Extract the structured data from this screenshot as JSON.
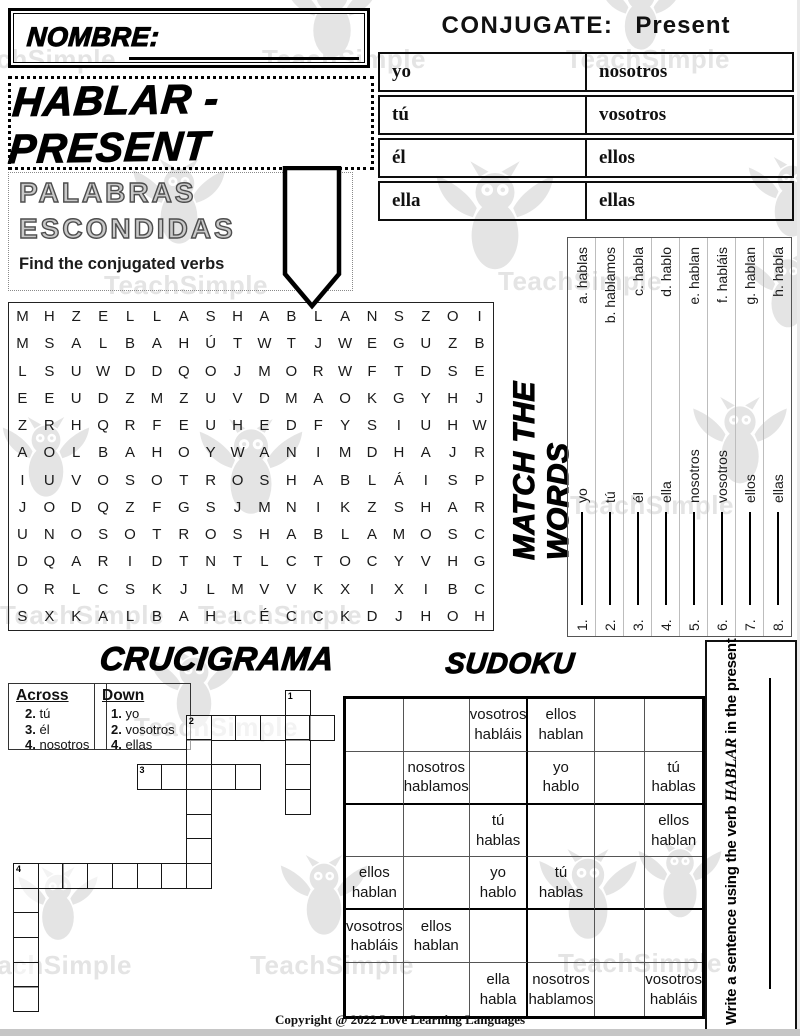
{
  "watermark": {
    "text": "TeachSimple",
    "color": "#e4e4e4",
    "items": [
      {
        "t": "owl",
        "x": 280,
        "y": -30,
        "s": 104
      },
      {
        "t": "owl",
        "x": 596,
        "y": -26,
        "s": 90
      },
      {
        "t": "text",
        "x": -48,
        "y": 44
      },
      {
        "t": "text",
        "x": 262,
        "y": 44
      },
      {
        "t": "text",
        "x": 566,
        "y": 44
      },
      {
        "t": "owl",
        "x": 128,
        "y": 158,
        "s": 102
      },
      {
        "t": "owl",
        "x": 430,
        "y": 160,
        "s": 130
      },
      {
        "t": "owl",
        "x": 744,
        "y": 156,
        "s": 96
      },
      {
        "t": "text",
        "x": 104,
        "y": 270
      },
      {
        "t": "text",
        "x": 498,
        "y": 266
      },
      {
        "t": "owl",
        "x": 742,
        "y": 250,
        "s": 92
      },
      {
        "t": "owl",
        "x": -2,
        "y": 416,
        "s": 96
      },
      {
        "t": "owl",
        "x": 194,
        "y": 418,
        "s": 114
      },
      {
        "t": "owl",
        "x": 688,
        "y": 396,
        "s": 104
      },
      {
        "t": "text",
        "x": 570,
        "y": 490
      },
      {
        "t": "text",
        "x": 0,
        "y": 600
      },
      {
        "t": "text",
        "x": 198,
        "y": 600
      },
      {
        "t": "owl",
        "x": 146,
        "y": 648,
        "s": 96
      },
      {
        "t": "text",
        "x": 134,
        "y": 712
      },
      {
        "t": "owl",
        "x": 14,
        "y": 866,
        "s": 88
      },
      {
        "t": "owl",
        "x": 276,
        "y": 854,
        "s": 96
      },
      {
        "t": "owl",
        "x": 534,
        "y": 848,
        "s": 108
      },
      {
        "t": "owl",
        "x": 634,
        "y": 840,
        "s": 92
      },
      {
        "t": "text",
        "x": -32,
        "y": 950
      },
      {
        "t": "text",
        "x": 250,
        "y": 950
      },
      {
        "t": "text",
        "x": 558,
        "y": 948
      }
    ]
  },
  "nombre": {
    "label": "NOMBRE:"
  },
  "conjugate": {
    "title": "CONJUGATE:",
    "tense": "Present",
    "rows": [
      [
        "yo",
        "nosotros"
      ],
      [
        "tú",
        "vosotros"
      ],
      [
        "él",
        "ellos"
      ],
      [
        "ella",
        "ellas"
      ]
    ]
  },
  "main_title": "HABLAR - PRESENT",
  "palabras": {
    "line1": "PALABRAS",
    "line2": "ESCONDIDAS",
    "subtitle": "Find the conjugated verbs"
  },
  "wordsearch": {
    "rows": [
      "MHZELLASHABLANSZOI",
      "MSALBAHÚTWTJWEGUZB",
      "LSUWDDQOJMORWFTDSE",
      "EEUDZMZUVDMAOKGYHJ",
      "ZRHQRFEUHEDFYSIUHW",
      "AOLBAHOYWANIMDHAJR",
      "IUVOSOTROSHABLÁISP",
      "JODQZFGSJMNIKZSHAR",
      "UNOSOTROSHABLAMOSC",
      "DQARIDTNTLCTOCYVHG",
      "ORLCSKJLMVVKXIXIBC",
      "SXKALBAHLÉCCKDJHOH"
    ]
  },
  "match": {
    "title": "MATCH THE WORDS",
    "items": [
      {
        "num": "1.",
        "pronoun": "yo",
        "letter": "a.",
        "verb": "hablas"
      },
      {
        "num": "2.",
        "pronoun": "tú",
        "letter": "b.",
        "verb": "hablamos"
      },
      {
        "num": "3.",
        "pronoun": "él",
        "letter": "c.",
        "verb": "habla"
      },
      {
        "num": "4.",
        "pronoun": "ella",
        "letter": "d.",
        "verb": "hablo"
      },
      {
        "num": "5.",
        "pronoun": "nosotros",
        "letter": "e.",
        "verb": "hablan"
      },
      {
        "num": "6.",
        "pronoun": "vosotros",
        "letter": "f.",
        "verb": "habláis"
      },
      {
        "num": "7.",
        "pronoun": "ellos",
        "letter": "g.",
        "verb": "hablan"
      },
      {
        "num": "8.",
        "pronoun": "ellas",
        "letter": "h.",
        "verb": "habla"
      }
    ]
  },
  "crossword": {
    "title": "CRUCIGRAMA",
    "clues": {
      "across_header": "Across",
      "down_header": "Down",
      "across": [
        {
          "num": "2.",
          "text": "tú"
        },
        {
          "num": "3.",
          "text": "él"
        },
        {
          "num": "4.",
          "text": "nosotros"
        }
      ],
      "down": [
        {
          "num": "1.",
          "text": "yo"
        },
        {
          "num": "2.",
          "text": "vosotros"
        },
        {
          "num": "4.",
          "text": "ellas"
        }
      ]
    },
    "words": [
      {
        "label": "1",
        "dir": "down",
        "row": 0,
        "col": 11,
        "len": 5
      },
      {
        "label": "2",
        "dir": "across",
        "row": 1,
        "col": 7,
        "len": 6
      },
      {
        "label": "2",
        "dir": "down",
        "row": 1,
        "col": 7,
        "len": 7
      },
      {
        "label": "3",
        "dir": "across",
        "row": 3,
        "col": 5,
        "len": 5
      },
      {
        "label": "4",
        "dir": "across",
        "row": 7,
        "col": 0,
        "len": 8
      },
      {
        "label": "4",
        "dir": "down",
        "row": 7,
        "col": 0,
        "len": 6
      }
    ]
  },
  "sudoku": {
    "title": "SUDOKU",
    "rows": [
      [
        "",
        "",
        "vosotros habláis",
        "ellos hablan",
        "",
        ""
      ],
      [
        "",
        "nosotros hablamos",
        "",
        "yo hablo",
        "",
        "tú hablas"
      ],
      [
        "",
        "",
        "tú hablas",
        "",
        "",
        "ellos hablan"
      ],
      [
        "ellos hablan",
        "",
        "yo hablo",
        "tú hablas",
        "",
        ""
      ],
      [
        "vosotros habláis",
        "ellos hablan",
        "",
        "",
        "",
        ""
      ],
      [
        "",
        "",
        "ella habla",
        "nosotros hablamos",
        "",
        "vosotros habláis"
      ]
    ]
  },
  "sentence": {
    "pre": "Write a sentence using the verb",
    "verb": "HABLAR",
    "post": "in the present"
  },
  "copyright": "Copyright @ 2022 Love Learning Languages"
}
